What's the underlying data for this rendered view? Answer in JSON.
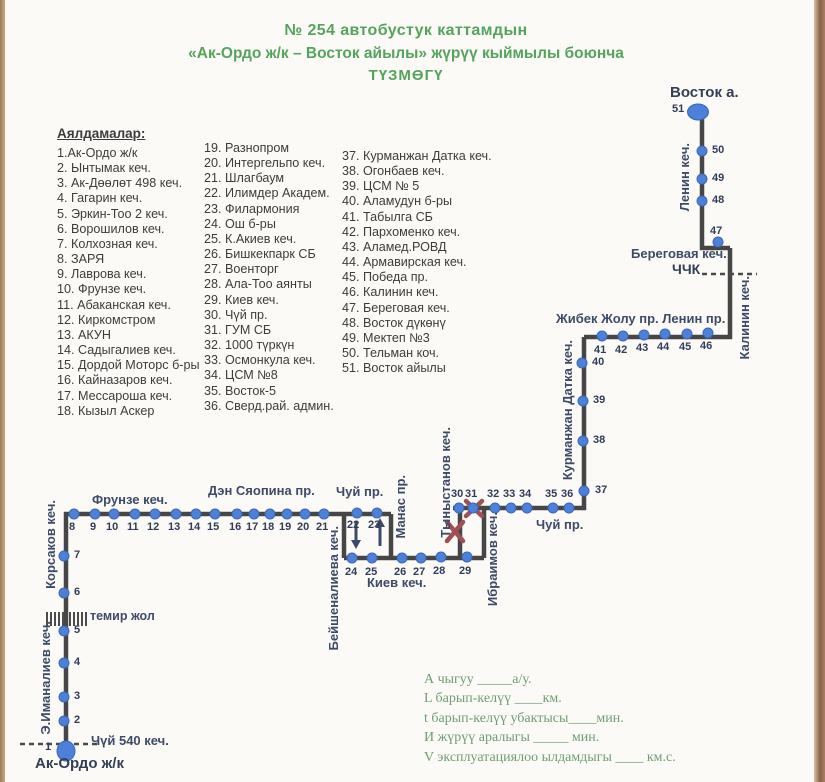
{
  "header": {
    "line1": "№ 254  автобустук каттамдын",
    "line2": "«Ак-Ордо ж/к – Восток айылы» жүрүү кыймылы боюнча",
    "line3": "ТҮЗМӨГҮ"
  },
  "stops_list": {
    "heading": "Аялдамалар:",
    "col1": [
      "1.Ак-Ордо ж/к",
      "2. Ынтымак кеч.",
      "3. Ак-Дөөлөт 498 кеч.",
      "4. Гагарин кеч.",
      "5. Эркин-Тоо 2 кеч.",
      "6. Ворошилов кеч.",
      "7. Колхозная кеч.",
      "8. ЗАРЯ",
      "9. Лаврова кеч.",
      "10. Фрунзе кеч.",
      "11. Абаканская кеч.",
      "12. Киркомстром",
      "13. АКУН",
      "14. Садыгалиев кеч.",
      "15. Дордой Моторс б-ры",
      "16. Кайназаров кеч.",
      "17. Мессароша кеч.",
      "18. Кызыл Аскер"
    ],
    "col2": [
      "19. Разнопром",
      "20. Интергельпо кеч.",
      "21. Шлагбаум",
      "22. Илимдер Академ.",
      "23. Филармония",
      "24. Ош б-ры",
      "25. К.Акиев кеч.",
      "26. Бишкекпарк СБ",
      "27. Военторг",
      "28. Ала-Тоо аянты",
      "29. Киев кеч.",
      "30. Чүй пр.",
      "31. ГУМ СБ",
      "32. 1000 түркүн",
      "33. Осмонкула кеч.",
      "34. ЦСМ №8",
      "35. Восток-5",
      "36. Сверд.рай. админ."
    ],
    "col3": [
      "37. Курманжан Датка кеч.",
      "38. Огонбаев кеч.",
      "39. ЦСМ № 5",
      "40. Аламудун б-ры",
      "41. Табылга СБ",
      "42. Пархоменко кеч.",
      "43. Аламед.РОВД",
      "44. Армавирская кеч.",
      "45. Победа пр.",
      "46. Калинин кеч.",
      "47. Береговая кеч.",
      "48. Восток дүкөнү",
      "49. Мектеп №3",
      "50. Тельман коч.",
      "51. Восток айылы"
    ]
  },
  "map": {
    "street_labels": [
      {
        "text": "Восток а.",
        "x": 670,
        "y": 84,
        "size": 15,
        "bold": true
      },
      {
        "text": "Ленин кеч.",
        "x": 677,
        "y": 143,
        "vertical": true
      },
      {
        "text": "Береговая кеч.",
        "x": 631,
        "y": 246
      },
      {
        "text": "ЧЧК",
        "x": 672,
        "y": 261,
        "size": 14,
        "bold": true
      },
      {
        "text": "Калинин кеч.",
        "x": 737,
        "y": 276,
        "vertical": true
      },
      {
        "text": "Жибек Жолу пр. Ленин пр.",
        "x": 556,
        "y": 311
      },
      {
        "text": "Курманжан Датка кеч.",
        "x": 560,
        "y": 340,
        "vertical": true
      },
      {
        "text": "Чуй пр.",
        "x": 536,
        "y": 517
      },
      {
        "text": "Тыныстанов кеч.",
        "x": 438,
        "y": 427,
        "vertical": true
      },
      {
        "text": "Ибраимов кеч.",
        "x": 485,
        "y": 512,
        "vertical": true
      },
      {
        "text": "Манас пр.",
        "x": 393,
        "y": 475,
        "vertical": true
      },
      {
        "text": "Бейшеналиева кеч.",
        "x": 326,
        "y": 526,
        "vertical": true
      },
      {
        "text": "Чуй пр.",
        "x": 336,
        "y": 484
      },
      {
        "text": "Киев кеч.",
        "x": 367,
        "y": 575
      },
      {
        "text": "Дэн Сяопина пр.",
        "x": 208,
        "y": 483
      },
      {
        "text": "Фрунзе кеч.",
        "x": 92,
        "y": 492
      },
      {
        "text": "Корсаков кеч.",
        "x": 43,
        "y": 500,
        "vertical": true
      },
      {
        "text": "темир жол",
        "x": 90,
        "y": 609,
        "size": 12.5
      },
      {
        "text": "Э.Иманалиев кеч.",
        "x": 38,
        "y": 621,
        "vertical": true
      },
      {
        "text": "Чүй 540 кеч.",
        "x": 91,
        "y": 733
      },
      {
        "text": "Ак-Ордо ж/к",
        "x": 35,
        "y": 755,
        "size": 15,
        "bold": true
      }
    ],
    "stops": [
      {
        "n": 1,
        "x": 66,
        "y": 751,
        "lx": 45,
        "ly": 741,
        "w": 19,
        "h": 21
      },
      {
        "n": 2,
        "x": 64,
        "y": 721,
        "lx": 74,
        "ly": 714
      },
      {
        "n": 3,
        "x": 64,
        "y": 697,
        "lx": 74,
        "ly": 690
      },
      {
        "n": 4,
        "x": 64,
        "y": 663,
        "lx": 74,
        "ly": 656
      },
      {
        "n": 5,
        "x": 64,
        "y": 631,
        "lx": 74,
        "ly": 624
      },
      {
        "n": 6,
        "x": 64,
        "y": 593,
        "lx": 74,
        "ly": 586
      },
      {
        "n": 7,
        "x": 64,
        "y": 556,
        "lx": 74,
        "ly": 549
      },
      {
        "n": 8,
        "x": 74,
        "y": 514,
        "lx": 69,
        "ly": 521
      },
      {
        "n": 9,
        "x": 95,
        "y": 514,
        "lx": 90,
        "ly": 521
      },
      {
        "n": 10,
        "x": 114,
        "y": 514,
        "lx": 106,
        "ly": 521
      },
      {
        "n": 11,
        "x": 135,
        "y": 514,
        "lx": 127,
        "ly": 521
      },
      {
        "n": 12,
        "x": 155,
        "y": 514,
        "lx": 147,
        "ly": 521
      },
      {
        "n": 13,
        "x": 176,
        "y": 514,
        "lx": 168,
        "ly": 521
      },
      {
        "n": 14,
        "x": 196,
        "y": 514,
        "lx": 188,
        "ly": 521
      },
      {
        "n": 15,
        "x": 215,
        "y": 514,
        "lx": 207,
        "ly": 521
      },
      {
        "n": 16,
        "x": 237,
        "y": 514,
        "lx": 229,
        "ly": 521
      },
      {
        "n": 17,
        "x": 254,
        "y": 514,
        "lx": 246,
        "ly": 521
      },
      {
        "n": 18,
        "x": 270,
        "y": 514,
        "lx": 262,
        "ly": 521
      },
      {
        "n": 19,
        "x": 287,
        "y": 514,
        "lx": 279,
        "ly": 521
      },
      {
        "n": 20,
        "x": 305,
        "y": 514,
        "lx": 297,
        "ly": 521
      },
      {
        "n": 21,
        "x": 324,
        "y": 514,
        "lx": 316,
        "ly": 521
      },
      {
        "n": 22,
        "x": 357,
        "y": 513,
        "lx": 347,
        "ly": 519
      },
      {
        "n": 23,
        "x": 377,
        "y": 513,
        "lx": 368,
        "ly": 519
      },
      {
        "n": 24,
        "x": 352,
        "y": 558,
        "lx": 345,
        "ly": 566
      },
      {
        "n": 25,
        "x": 372,
        "y": 558,
        "lx": 365,
        "ly": 566
      },
      {
        "n": 26,
        "x": 402,
        "y": 558,
        "lx": 394,
        "ly": 566
      },
      {
        "n": 27,
        "x": 421,
        "y": 558,
        "lx": 413,
        "ly": 566
      },
      {
        "n": 28,
        "x": 441,
        "y": 557,
        "lx": 433,
        "ly": 565
      },
      {
        "n": 29,
        "x": 467,
        "y": 557,
        "lx": 459,
        "ly": 565
      },
      {
        "n": 30,
        "x": 459,
        "y": 508,
        "lx": 451,
        "ly": 488
      },
      {
        "n": 31,
        "x": 473,
        "y": 508,
        "lx": 465,
        "ly": 488
      },
      {
        "n": 32,
        "x": 495,
        "y": 508,
        "lx": 487,
        "ly": 488
      },
      {
        "n": 33,
        "x": 511,
        "y": 508,
        "lx": 503,
        "ly": 488
      },
      {
        "n": 34,
        "x": 527,
        "y": 508,
        "lx": 519,
        "ly": 488
      },
      {
        "n": 35,
        "x": 553,
        "y": 508,
        "lx": 545,
        "ly": 488
      },
      {
        "n": 36,
        "x": 569,
        "y": 508,
        "lx": 561,
        "ly": 488
      },
      {
        "n": 37,
        "x": 584,
        "y": 491,
        "lx": 595,
        "ly": 484
      },
      {
        "n": 38,
        "x": 583,
        "y": 441,
        "lx": 593,
        "ly": 434
      },
      {
        "n": 39,
        "x": 583,
        "y": 401,
        "lx": 593,
        "ly": 394
      },
      {
        "n": 40,
        "x": 582,
        "y": 363,
        "lx": 592,
        "ly": 356
      },
      {
        "n": 41,
        "x": 602,
        "y": 336,
        "lx": 594,
        "ly": 344
      },
      {
        "n": 42,
        "x": 623,
        "y": 336,
        "lx": 615,
        "ly": 344
      },
      {
        "n": 43,
        "x": 644,
        "y": 335,
        "lx": 636,
        "ly": 342
      },
      {
        "n": 44,
        "x": 665,
        "y": 334,
        "lx": 657,
        "ly": 341
      },
      {
        "n": 45,
        "x": 687,
        "y": 334,
        "lx": 679,
        "ly": 341
      },
      {
        "n": 46,
        "x": 708,
        "y": 333,
        "lx": 700,
        "ly": 340
      },
      {
        "n": 47,
        "x": 718,
        "y": 242,
        "lx": 710,
        "ly": 225
      },
      {
        "n": 48,
        "x": 702,
        "y": 201,
        "lx": 712,
        "ly": 194
      },
      {
        "n": 49,
        "x": 702,
        "y": 179,
        "lx": 712,
        "ly": 172
      },
      {
        "n": 50,
        "x": 702,
        "y": 151,
        "lx": 712,
        "ly": 144
      },
      {
        "n": 51,
        "x": 698,
        "y": 112,
        "lx": 672,
        "ly": 103,
        "w": 22,
        "h": 17
      }
    ]
  },
  "notes": [
    "А чыгуу  _____а/у.",
    "L барып-келүү  ____км.",
    "t барып-келүү убактысы____мин.",
    "И жүрүү аралыгы _____   мин.",
    "V эксплуатациялоо ылдамдыгы ____ км.с."
  ],
  "colors": {
    "accent_green": "#55a45c",
    "dot_blue": "#4d80d8",
    "route_line": "#464646",
    "label_navy": "#3d4a68",
    "closed_red": "#a04f55",
    "note_green": "#6f9e72",
    "scan_edge_tan": "#a5805f"
  }
}
